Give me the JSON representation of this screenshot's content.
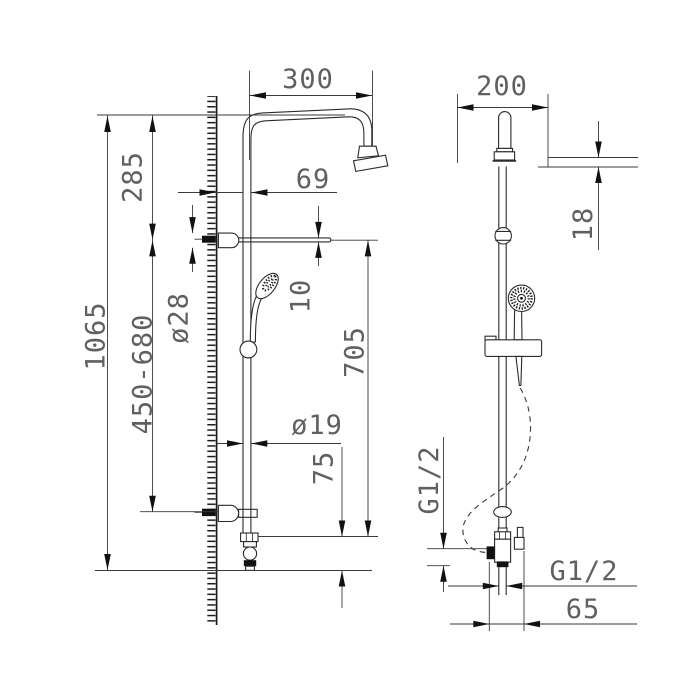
{
  "page": {
    "background_color": "#ffffff",
    "line_color": "#2b2b2b",
    "dim_text_color": "#606060"
  },
  "drawing": {
    "front_view": {
      "dimensions": {
        "arm_reach": "300",
        "top_to_bracket": "285",
        "wall_to_pipe": "69",
        "bracket_diameter": "ø28",
        "shelf_thickness": "10",
        "total_height": "1065",
        "slide_range": "450-680",
        "pipe_diameter": "ø19",
        "bracket_to_outlet": "705",
        "outlet_height": "75"
      }
    },
    "side_view": {
      "dimensions": {
        "head_width": "200",
        "head_thickness": "18",
        "inlet_thread": "G1/2",
        "outlet_thread": "G1/2",
        "outlet_offset": "65"
      }
    }
  }
}
